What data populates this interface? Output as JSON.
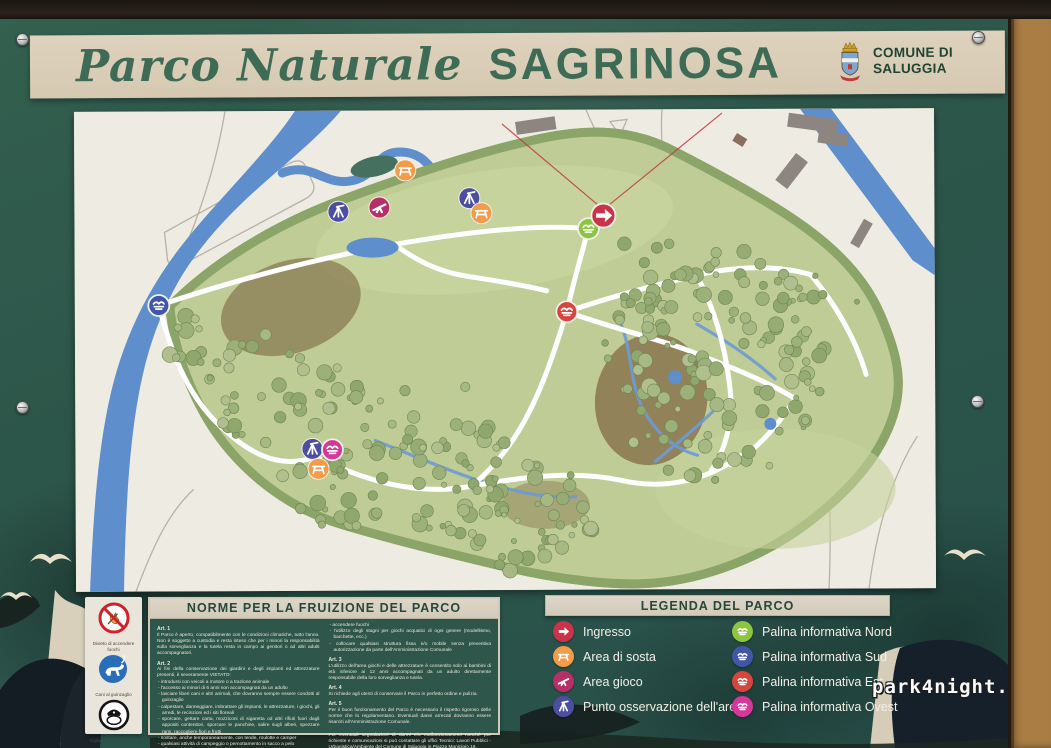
{
  "title": {
    "script": "Parco Naturale",
    "name": "SAGRINOSA"
  },
  "commune": {
    "line1": "COMUNE DI",
    "line2": "SALUGGIA"
  },
  "watermark": "park4night.com",
  "pictograms": [
    {
      "name": "no-fire",
      "label": "Divieto di accendere fuochi"
    },
    {
      "name": "dog-leash",
      "label": "Cani al guinzaglio"
    },
    {
      "name": "police",
      "label": "Vigilanza Polizia Locale"
    }
  ],
  "rules": {
    "header": "NORME PER LA FRUIZIONE DEL PARCO",
    "col_left": [
      {
        "heading": "Art. 1",
        "text": "Il Parco è aperto, compatibilmente con le condizioni climatiche, tutto l'anno. Non è soggetto a custodia e resta inteso che per i minori la responsabilità sulla sorveglianza e la tutela resta in campo ai genitori o ad altri adulti accompagnatori."
      },
      {
        "heading": "Art. 2",
        "text": "Ai fini della conservazione dei giardini e degli impianti ed attrezzature presenti, è severamente VIETATO:",
        "bullets": [
          "introdursi con veicoli a motore o a trazione animale",
          "l'accesso ai minori di 6 anni non accompagnati da un adulto",
          "lasciare liberi cani e altri animali, che dovranno sempre essere condotti al guinzaglio",
          "calpestare, danneggiare, imbrattare gli impianti, le attrezzature, i giochi, gli arredi, le recinzioni ed i siti floreali",
          "sporcare, gettare carta, mozziconi di sigaretta od altri rifiuti fuori dagli appositi contenitori, sporcare le panchine, salire sugli alberi, spezzare rami, raccogliere fiori e frutti",
          "sostare, anche temporaneamente, con tende, roulotte e camper",
          "qualsiasi attività di campeggio o pernottamento in sacco a pelo",
          "utilizzare biciclette e tricicli al di fuori dei sentieri tracciati",
          "praticare giochi pericolosi per gli utenti del Parco",
          "introdurre oggetti di qualsiasi natura",
          "esercitare commercio ambulante abusivo, collocare baracche, chioschi, bancarelle, panche e qualsiasi altra struttura fissa o mobile"
        ]
      }
    ],
    "col_right": [
      {
        "bullets": [
          "accendere fuochi",
          "l'utilizzo degli stagni per giochi acquatici di ogni genere (modellismo, barchette, ecc.)",
          "collocare qualsiasi struttura fissa e/o mobile senza preventiva autorizzazione da parte dell'Amministrazione Comunale"
        ]
      },
      {
        "heading": "Art. 3",
        "text": "L'utilizzo dell'area giochi e delle attrezzature è consentito solo ai bambini di età inferiore ai 12 anni accompagnati da un adulto direttamente responsabile della loro sorveglianza e tutela."
      },
      {
        "heading": "Art. 4",
        "text": "Si richiede agli utenti di conservare il Parco in perfetto ordine e pulizia."
      },
      {
        "heading": "Art. 5",
        "text": "Per il buon funzionamento del Parco è necessario il rispetto rigoroso delle norme che lo regolamentano. Eventuali danni arrecati dovranno essere risarciti all'Amministrazione Comunale."
      },
      {
        "gap": true,
        "text": "Per eventuali segnalazioni di danni e/o malfunzionamenti nonché per richieste e comunicazioni si può contattare gli uffici Tecnici: Lavori Pubblici - Urbanistica/Ambiente del Comune di Saluggia in Piazza Municipio 16."
      }
    ]
  },
  "legend": {
    "header": "LEGENDA DEL PARCO",
    "columns": [
      [
        {
          "label": "Ingresso",
          "kind": "ingresso",
          "icon": "arrow-right-icon"
        },
        {
          "label": "Area di sosta",
          "kind": "area_sosta",
          "icon": "picnic-area-icon"
        },
        {
          "label": "Area gioco",
          "kind": "area_gioco",
          "icon": "seesaw-icon"
        },
        {
          "label": "Punto osservazione dell'area",
          "kind": "punto_osservazione",
          "icon": "observation-icon"
        }
      ],
      [
        {
          "label": "Palina informativa Nord",
          "kind": "palina_nord",
          "icon": "info-panel-icon"
        },
        {
          "label": "Palina informativa Sud",
          "kind": "palina_sud",
          "icon": "info-panel-icon"
        },
        {
          "label": "Palina informativa Est",
          "kind": "palina_est",
          "icon": "info-panel-icon"
        },
        {
          "label": "Palina informativa Ovest",
          "kind": "palina_ovest",
          "icon": "info-panel-icon"
        }
      ]
    ]
  },
  "map": {
    "marker_colors": {
      "ingresso": "#c9344a",
      "area_sosta": "#f29b49",
      "area_gioco": "#b72f68",
      "punto_osservazione": "#4c4e9f",
      "palina_nord": "#8cc63f",
      "palina_sud": "#4156a5",
      "palina_est": "#d7453f",
      "palina_ovest": "#d4399a"
    },
    "markers": [
      {
        "kind": "area_sosta",
        "x": 331,
        "y": 60
      },
      {
        "kind": "punto_osservazione",
        "x": 264,
        "y": 101
      },
      {
        "kind": "area_gioco",
        "x": 305,
        "y": 97
      },
      {
        "kind": "punto_osservazione",
        "x": 395,
        "y": 88
      },
      {
        "kind": "area_sosta",
        "x": 407,
        "y": 103
      },
      {
        "kind": "palina_nord",
        "x": 514,
        "y": 119
      },
      {
        "kind": "ingresso",
        "x": 529,
        "y": 106
      },
      {
        "kind": "palina_est",
        "x": 492,
        "y": 202
      },
      {
        "kind": "palina_sud",
        "x": 84,
        "y": 194
      },
      {
        "kind": "punto_osservazione",
        "x": 237,
        "y": 338
      },
      {
        "kind": "palina_ovest",
        "x": 257,
        "y": 339
      },
      {
        "kind": "area_sosta",
        "x": 243,
        "y": 358
      }
    ]
  }
}
